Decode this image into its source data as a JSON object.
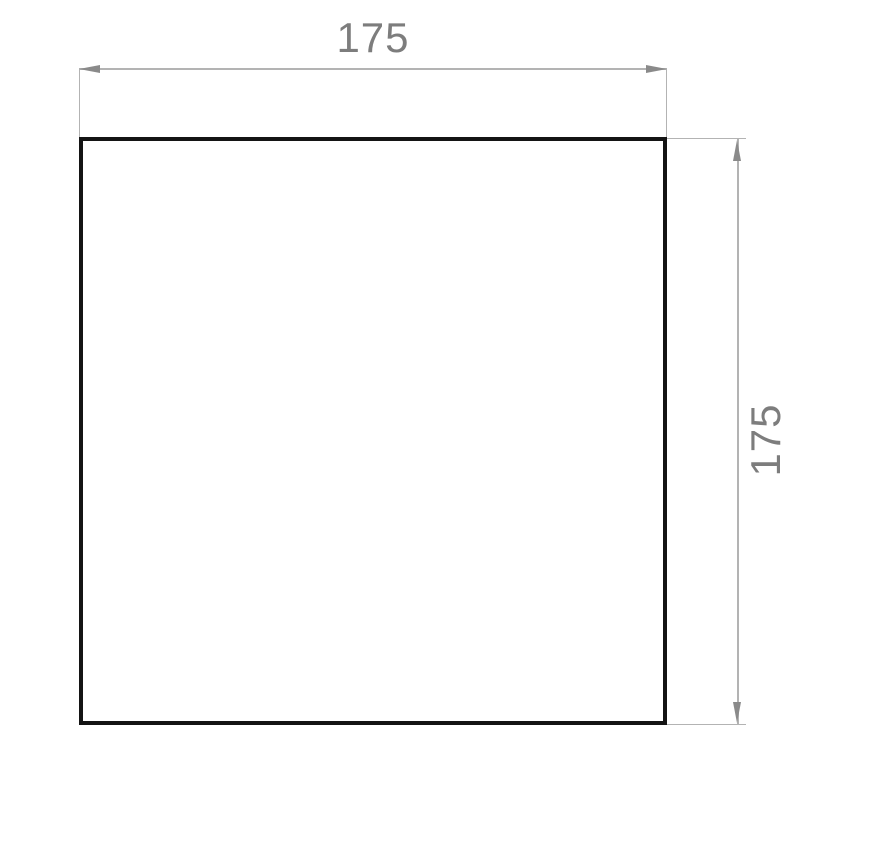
{
  "drawing": {
    "type": "technical-dimension-drawing",
    "shape": "square",
    "width_dimension": {
      "label": "175"
    },
    "height_dimension": {
      "label": "175"
    },
    "colors": {
      "background": "#ffffff",
      "outline": "#141414",
      "dimension_line": "#b3b3b3",
      "dimension_arrow": "#8a8a8a",
      "dimension_text": "#7d7d7d"
    }
  }
}
